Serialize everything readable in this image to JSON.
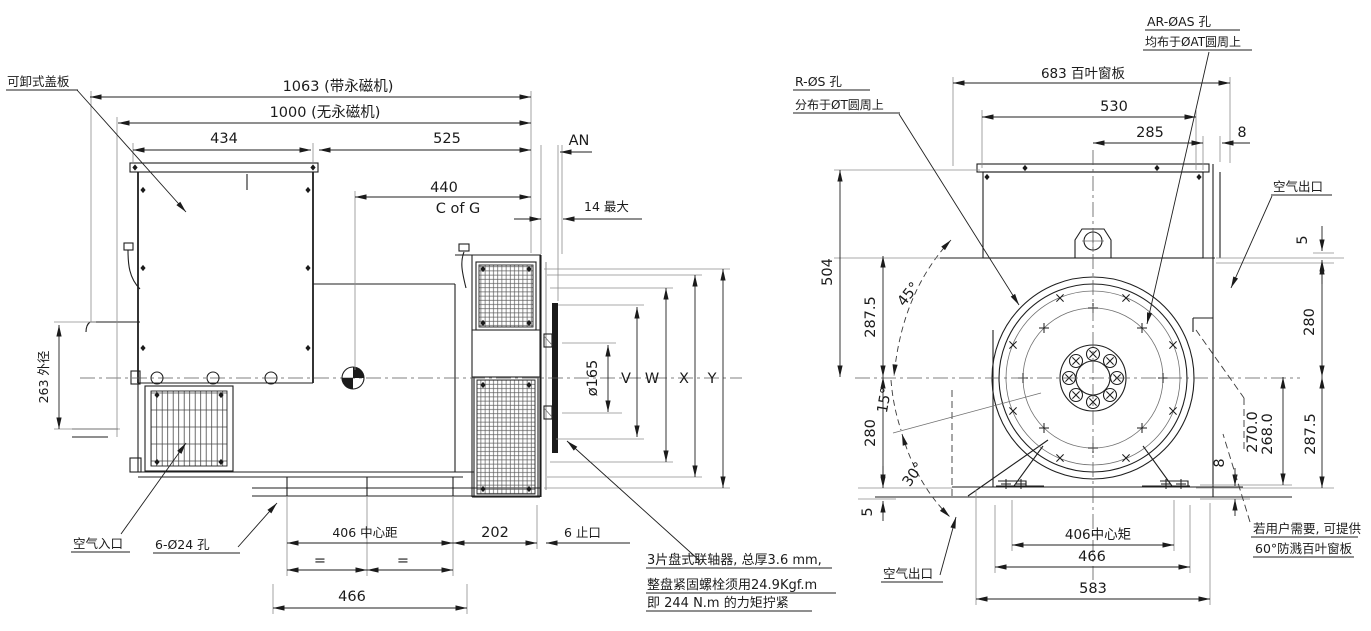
{
  "meta": {
    "background": "#ffffff",
    "line_color": "#1f1f1f"
  },
  "left_view": {
    "callouts": {
      "removable_cover": "可卸式盖板",
      "air_inlet": "空气入口",
      "holes_6_24": "6-Ø24 孔",
      "note_line1": "3片盘式联轴器, 总厚3.6 mm,",
      "note_line2": "整盘紧固螺栓须用24.9Kgf.m",
      "note_line3": "即 244 N.m 的力矩拧紧"
    },
    "dimensions": {
      "overall_with_pmg": "1063 (带永磁机)",
      "overall_without_pmg": "1000 (无永磁机)",
      "d434": "434",
      "d525": "525",
      "d440": "440",
      "c_of_g": "C of G",
      "an": "AN",
      "max14": "14 最大",
      "od263": "263 外径",
      "phi165": "ø165",
      "v": "V",
      "w": "W",
      "x": "X",
      "y": "Y",
      "center_406": "406 中心距",
      "d202": "202",
      "spigot6": "6 止口",
      "eq_left": "=",
      "eq_right": "=",
      "d466": "466"
    }
  },
  "right_view": {
    "callouts": {
      "ar_holes": "AR-ØAS 孔",
      "ar_holes_sub": "均布于ØAT圆周上",
      "r_holes": "R-ØS 孔",
      "r_holes_sub": "分布于ØT圆周上",
      "air_outlet_top": "空气出口",
      "air_outlet_bottom": "空气出口",
      "louver_note_line1": "若用户需要, 可提供",
      "louver_note_line2": "60°防溅百叶窗板"
    },
    "dimensions": {
      "louver_683": "683 百叶窗板",
      "d530": "530",
      "d285": "285",
      "d8_top": "8",
      "d5_top": "5",
      "d280_right": "280",
      "d287_5_right": "287.5",
      "d270": "270.0",
      "d268": "268.0",
      "d8_bottom": "8",
      "d504": "504",
      "d287_5_left": "287.5",
      "d280_left": "280",
      "d5_left": "5",
      "a45": "45°",
      "a15": "15°",
      "a30": "30°",
      "center_406": "406中心矩",
      "d466": "466",
      "d583": "583"
    }
  }
}
